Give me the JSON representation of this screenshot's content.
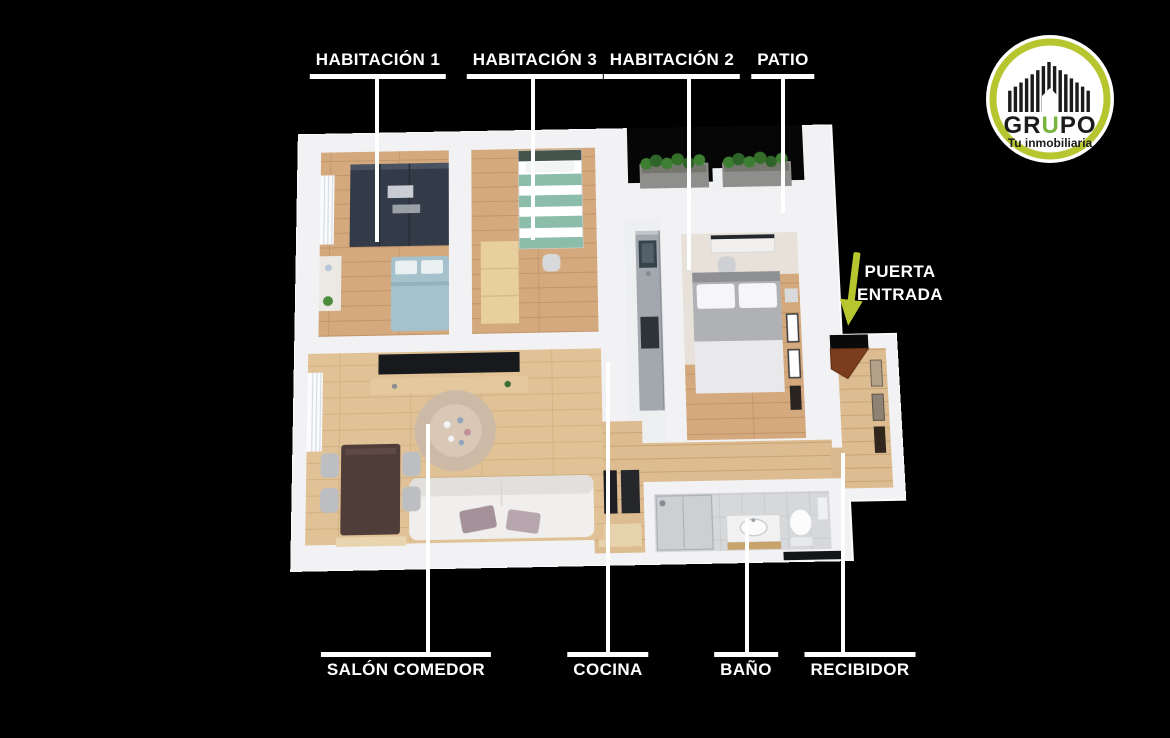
{
  "image_type": "real-estate 3d floor plan with room labels",
  "labels": {
    "top": [
      {
        "id": "habitacion-1",
        "text": "HABITACIÓN 1"
      },
      {
        "id": "habitacion-3",
        "text": "HABITACIÓN 3"
      },
      {
        "id": "habitacion-2",
        "text": "HABITACIÓN 2"
      },
      {
        "id": "patio",
        "text": "PATIO"
      }
    ],
    "bottom": [
      {
        "id": "salon-comedor",
        "text": "SALÓN COMEDOR"
      },
      {
        "id": "cocina",
        "text": "COCINA"
      },
      {
        "id": "bano",
        "text": "BAÑO"
      },
      {
        "id": "recibidor",
        "text": "RECIBIDOR"
      }
    ],
    "entrance": {
      "line1": "PUERTA",
      "line2": "ENTRADA"
    }
  },
  "logo": {
    "name_pre": "GR",
    "name_accent": "U",
    "name_post": "PO",
    "tagline": "Tu inmobiliaria"
  },
  "colors": {
    "background": "#000000",
    "label_white": "#ffffff",
    "accent_lime": "#b7c62f",
    "logo_green_u": "#79b43e",
    "wall_white": "#f2f2f4",
    "wood_bedroom": "#d3a97d",
    "wood_living": "#e1c296",
    "wardrobe_dark": "#343b48",
    "bed_blue": "#a5c2cc",
    "bed_teal": "#8cbcaa",
    "patio_floor": "#060606",
    "plant_green": "#3e7e33"
  }
}
